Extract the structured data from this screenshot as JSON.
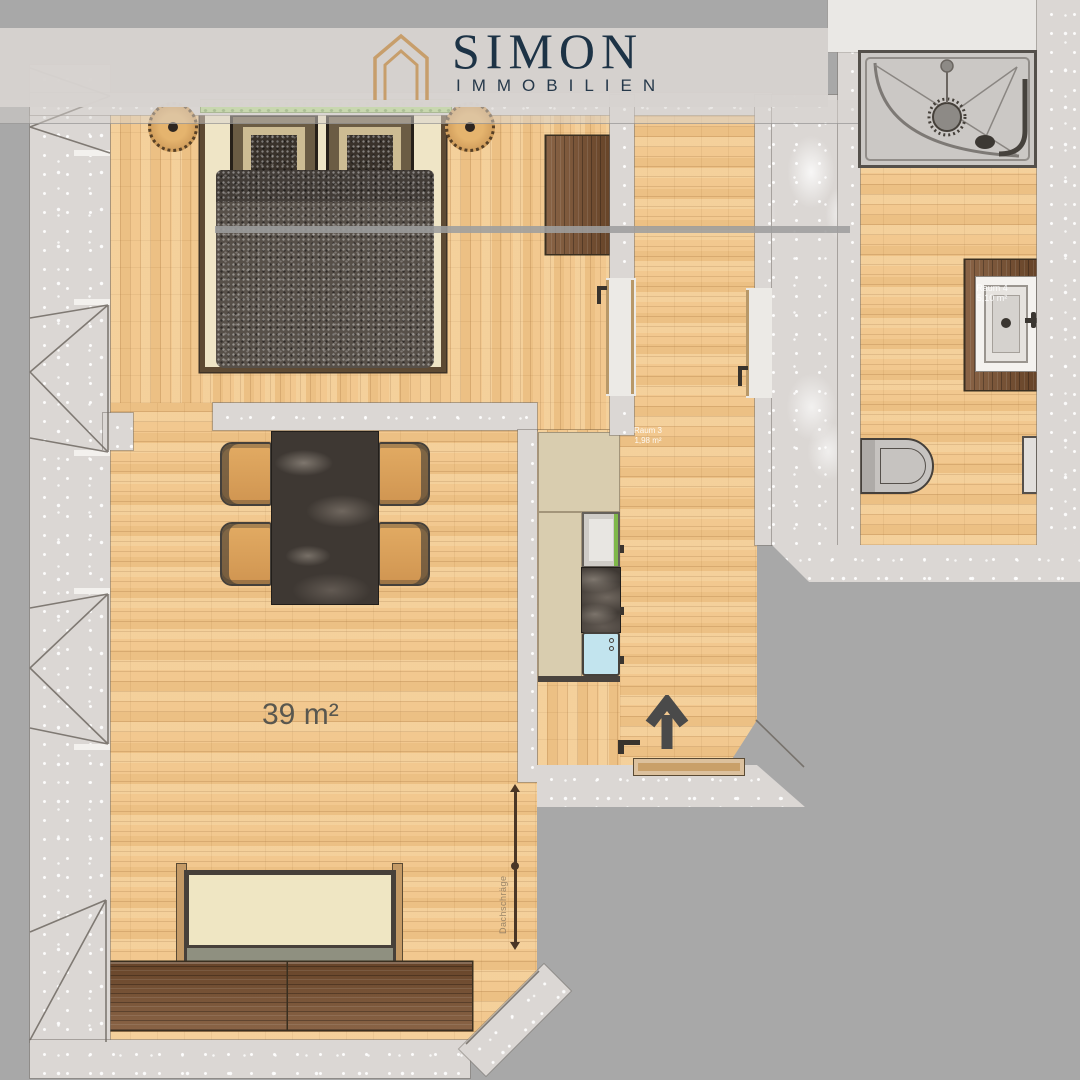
{
  "brand": {
    "name": "SIMON",
    "subtitle": "IMMOBILIEN",
    "logo_icon": "house-outline-icon"
  },
  "plan": {
    "living_room_area_label": "39 m²",
    "room_labels": [
      {
        "id": "room3",
        "name": "Raum 3",
        "area": "1,98 m²"
      },
      {
        "id": "room4",
        "name": "Raum 4",
        "area": "5,10 m²"
      }
    ],
    "dimension_label": "Dachschräge",
    "entrance_direction": "up"
  },
  "colors": {
    "background": "#a8a8a8",
    "header_band": "#d7d3cf",
    "wall": "#dbd7d4",
    "floor_wood": "#f0c68c",
    "furniture_wood": "#7c5231",
    "brand_navy": "#1d3346",
    "brand_tan": "#c79e6b",
    "window_green": "#b8da8e",
    "marble": "#3e3833",
    "kitchen_sink_blue": "#c2e4ee",
    "arrow": "#4a4a4a"
  },
  "icons": {
    "entrance": "arrow-up-icon"
  }
}
